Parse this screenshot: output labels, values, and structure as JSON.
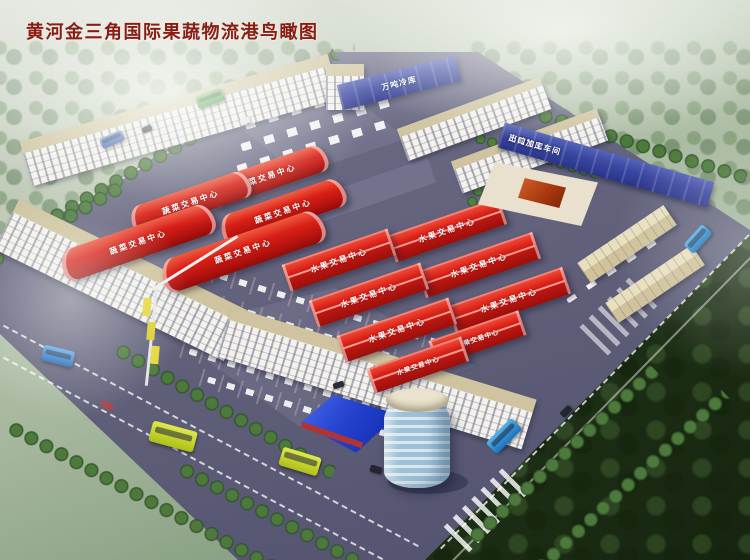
{
  "title": "黄河金三角国际果蔬物流港鸟瞰图",
  "labels": {
    "vegetable_center": "蔬菜交易中心",
    "fruit_center": "水果交易中心",
    "cold_storage": "万吨冷库",
    "export_workshop": "出口加工车间"
  },
  "colors": {
    "title_text": "#8b1c12",
    "market_roof_red": "#d32019",
    "cold_storage_blue": "#3a47a0",
    "ground_asphalt": "#60607b",
    "building_facade": "#f2efe6",
    "building_roof_tan": "#cfc49f",
    "tree_green": "#3f6f33",
    "forest_dark": "#243a1c",
    "glass_building_blue": "#2240cc",
    "bus_yellow": "#cfdf2e",
    "bus_blue": "#2f7fd4",
    "bus_green": "#3aa035"
  },
  "scene": {
    "view": "aerial bird's-eye rendering of a fruit and vegetable logistics port",
    "vegetable_hall_count": 5,
    "fruit_hall_count": 8,
    "vehicles": {
      "blue_buses": 3,
      "yellow_buses": 2,
      "green_bus": 1,
      "blue_truck": 1
    }
  }
}
